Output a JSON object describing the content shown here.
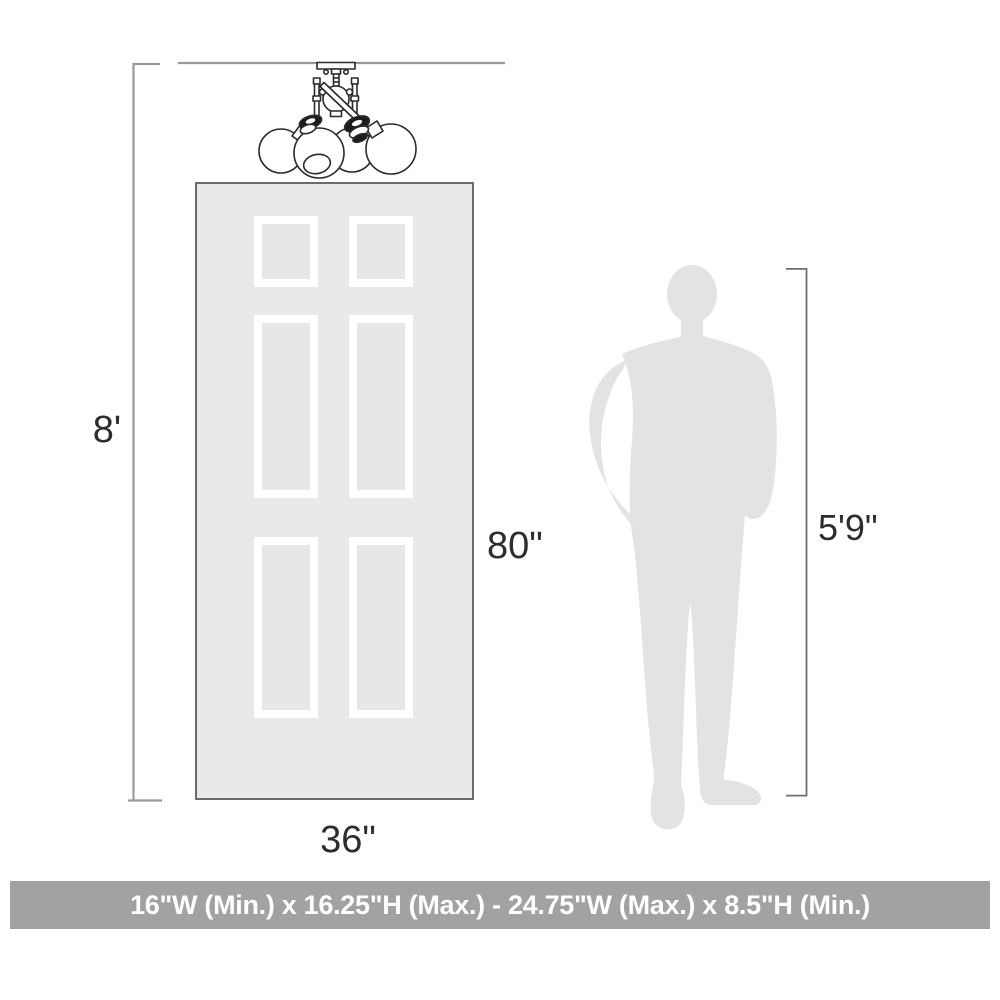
{
  "labels": {
    "ceiling_height": "8'",
    "door_height": "80\"",
    "door_width": "36\"",
    "person_height": "5'9\""
  },
  "banner": {
    "text": "16\"W (Min.) x 16.25\"H (Max.) - 24.75\"W (Max.) x 8.5\"H (Min.)"
  },
  "illustrations": {
    "fixture": "3-light semi-flush ceiling fixture line drawing",
    "door": "six-panel door silhouette",
    "person": "standing man silhouette"
  },
  "colors": {
    "door_fill": "#e9e9e9",
    "door_border": "#6b6b6b",
    "panel_frame": "#ffffff",
    "panel_inner": "#e7e7e7",
    "silhouette_gray": "#e3e3e3",
    "dimension_line_light": "#9a9a9a",
    "dimension_line_dark": "#6f6f6f",
    "label_text": "#2d2d2d",
    "banner_bg": "#a2a2a2",
    "banner_text": "#ffffff",
    "fixture_line": "#2b2b2b"
  }
}
